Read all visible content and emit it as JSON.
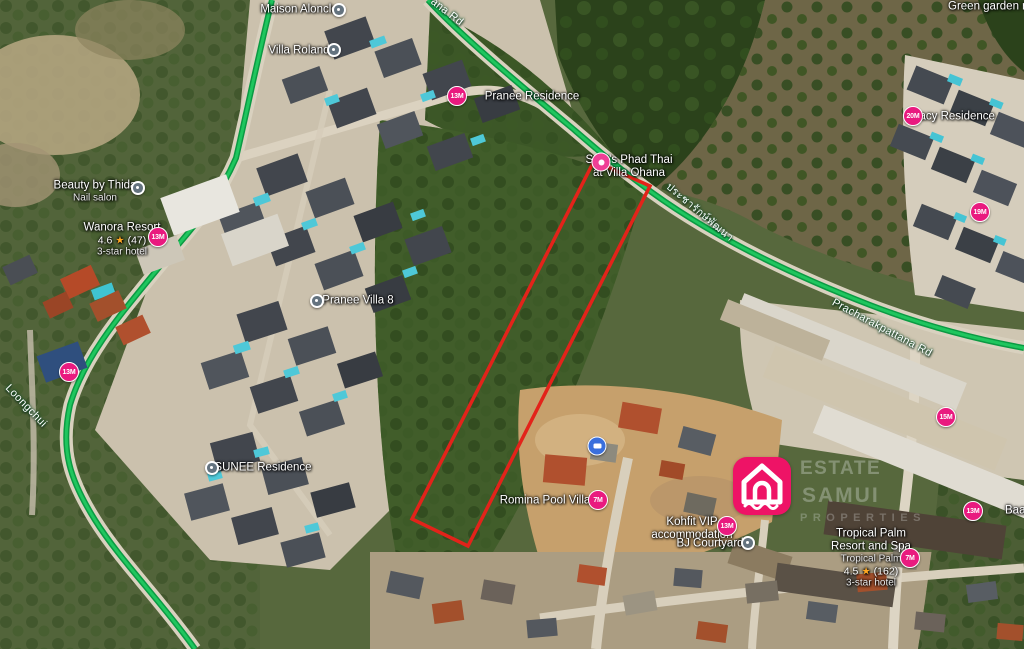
{
  "map": {
    "roads": {
      "top_partial": "ana Rd",
      "thai_name": "ประชารักษ์พัฒนา",
      "pracharak": "Pracharakpattana Rd",
      "loongchui": "Loongchui"
    },
    "pois": {
      "maison": {
        "label": "Maison Aloncle"
      },
      "villa_roland": {
        "label": "Villa Roland"
      },
      "pranee_residence": {
        "label": "Pranee Residence"
      },
      "soms": {
        "line1": "Som's Phad Thai",
        "line2": "at Villa Ohana"
      },
      "beauty": {
        "label": "Beauty by Thida",
        "sub": "Nail salon"
      },
      "wanora": {
        "label": "Wanora Resort",
        "rating": "4.6",
        "reviews": "(47)",
        "sub": "3-star hotel"
      },
      "pranee_villa8": {
        "label": "Pranee Villa 8"
      },
      "sunee": {
        "label": "SUNEE Residence"
      },
      "romina": {
        "label": "Romina Pool Villa"
      },
      "kohfit": {
        "line1": "Kohfit VIP",
        "line2": "accommodation"
      },
      "bj": {
        "label": "BJ Courtyard"
      },
      "tracy": {
        "label": "Tracy Residence"
      },
      "green_garden": {
        "label": "Green garden rest",
        "sub": "Family-"
      },
      "baan_sus": {
        "label": "Baan Sus"
      },
      "tropical": {
        "line1": "Tropical Palm",
        "line2": "Resort and Spa",
        "sub": "Tropical Palm",
        "rating": "4.5",
        "reviews": "(162)",
        "hotel": "3-star hotel"
      }
    },
    "markers": {
      "pranee": "13M",
      "wanora": "13M",
      "loongchui_area": "13M",
      "topright": "19M",
      "midright": "15M",
      "tracy": "20M",
      "romina": "7M",
      "kohfit": "13M",
      "baansus": "13M",
      "tropical": "7M"
    },
    "icons": {
      "star": "★"
    },
    "watermark": {
      "l1": "ESTATE",
      "l2": "SAMUI",
      "l3": "PROPERTIES"
    },
    "colors": {
      "badge_pink": "#e91a7f",
      "road_green": "#14b45a",
      "plot_red": "#e3231a",
      "logo_pink": "#ee1366"
    }
  }
}
